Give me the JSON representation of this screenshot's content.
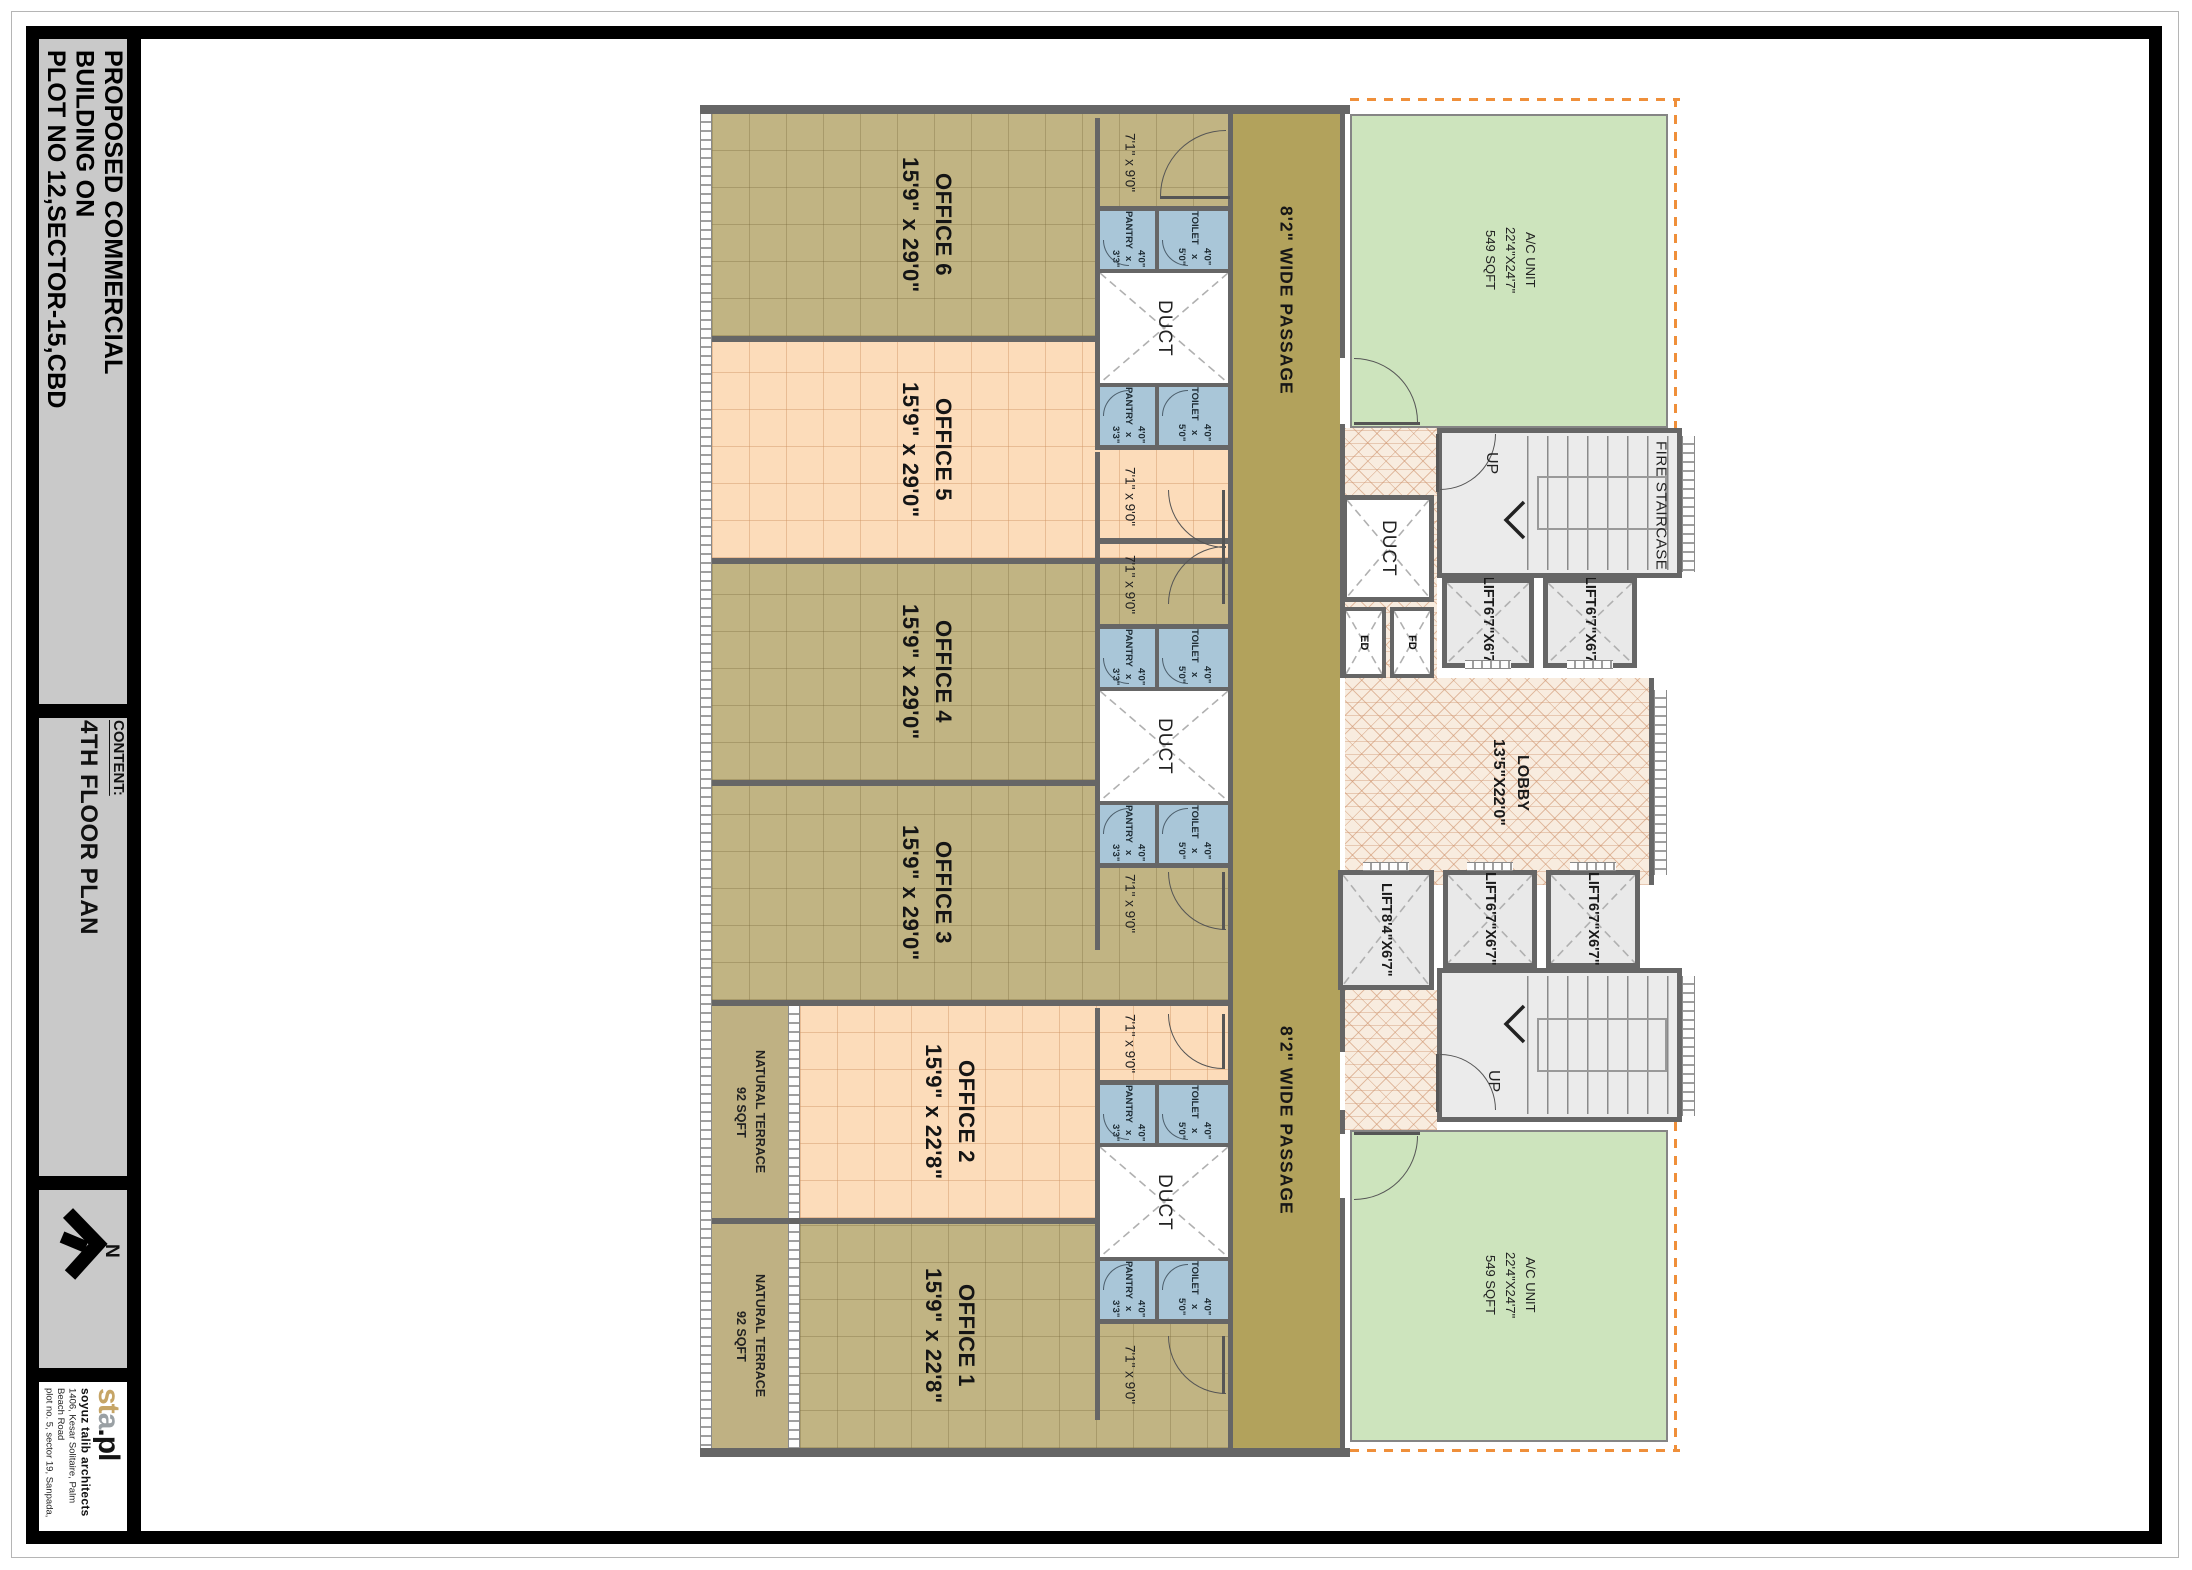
{
  "sheet": {
    "project_title_lines": [
      "PROPOSED COMMERCIAL",
      "BUILDING ON",
      "PLOT NO 12,SECTOR-15,CBD"
    ],
    "content_label": "CONTENT:",
    "content_value": "4TH FLOOR PLAN",
    "north_label": "N",
    "logo": {
      "part1": "st",
      "part2": "a",
      "part3": ".pl"
    },
    "firm": {
      "name": "soyuz talib architects",
      "address_line1": "1406, Kesar Solitaire, Palm Beach Road",
      "address_line2": "plot no. 5, sector 19, Sanpada, Navi Mumbai",
      "phone": "Ph. No. 27810762 / 63"
    }
  },
  "plan": {
    "offices": [
      {
        "name": "OFFICE 1",
        "size": "15'9\" x 22'8\""
      },
      {
        "name": "OFFICE 2",
        "size": "15'9\" x 22'8\""
      },
      {
        "name": "OFFICE 3",
        "size": "15'9\" x 29'0\""
      },
      {
        "name": "OFFICE 4",
        "size": "15'9\" x 29'0\""
      },
      {
        "name": "OFFICE 5",
        "size": "15'9\" x 29'0\""
      },
      {
        "name": "OFFICE 6",
        "size": "15'9\" x 29'0\""
      }
    ],
    "terrace": {
      "name": "NATURAL TERRACE",
      "size": "92 SQFT"
    },
    "entry_size": "7'1\" x 9'0\"",
    "pantry": {
      "name": "PANTRY",
      "size": "4'0\" x 3'3\""
    },
    "toilet": {
      "name": "TOILET",
      "size": "4'0\" x 5'0\""
    },
    "duct_label": "DUCT",
    "passage_label": "8'2\" WIDE PASSAGE",
    "ac_unit": {
      "name": "A/C UNIT",
      "size": "22'4\"X24'7\"",
      "area": "549 SQFT"
    },
    "lobby": {
      "name": "LOBBY",
      "size": "13'5\"X22'0\""
    },
    "lift_small": {
      "name": "LIFT",
      "size": "6'7\"X6'7\""
    },
    "lift_large": {
      "name": "LIFT",
      "size": "8'4\"X6'7\""
    },
    "fire_staircase_label": "FIRE STAIRCASE",
    "up_label": "UP",
    "fd_label": "FD",
    "ed_label": "ED"
  },
  "colors": {
    "office_khaki": "#c1b483",
    "office_peach": "#fcdcba",
    "passage_olive": "#b2a25c",
    "ac_green": "#cde4bd",
    "wet_area_blue": "#a9c6d8",
    "lobby_hatch": "#f8ecdf",
    "wall_gray": "#666666",
    "panel_gray": "#c9c9c9",
    "boundary_orange": "#ef8f3a"
  }
}
